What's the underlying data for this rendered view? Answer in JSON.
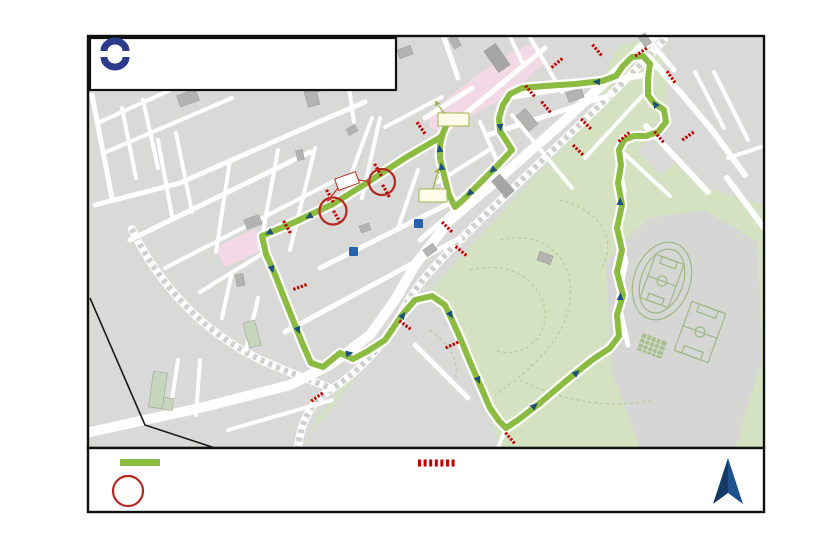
{
  "page": {
    "side_label": "page 2/3"
  },
  "title_box": {
    "line1": "Flèche du Sud 2023",
    "line2": "Prologue mercredi, le 17 mai 2023",
    "logo_text": "esch"
  },
  "legend": {
    "route_label": "Parcours du Prologue de la Flèche du Sud",
    "closure_line1": "Fermeture du parcours et des rues adjacentes",
    "closure_line2": "de 15.00 heures jusqu'à 20.00 heures",
    "ppo_title": "PPO",
    "ppo_desc": "Point de passage obligatoire"
  },
  "markers": {
    "depart": "Départ",
    "arrivee": "Arrivée",
    "ppo": "PPO",
    "north_label": "N",
    "museum_icon": "M"
  },
  "colors": {
    "route_green": "#8cbb41",
    "closure_red": "#c00000",
    "ppo_red": "#b5291f",
    "arrow_navy": "#1d4f7c",
    "park_green": "#d5e2c2",
    "pink_zone": "#f3d9e6",
    "map_gray": "#d9d9d7",
    "logo_blue": "#2c3a8c"
  },
  "map": {
    "street_labels": [
      {
        "t": "STALINGRAD",
        "x": 99,
        "y": 140,
        "r": 80
      },
      {
        "t": "HUGO",
        "x": 122,
        "y": 96,
        "r": -25
      },
      {
        "t": "EDISON",
        "x": 138,
        "y": 124,
        "r": -22
      },
      {
        "t": "CHAMPS",
        "x": 163,
        "y": 178,
        "r": 78
      },
      {
        "t": "ARGENTINE",
        "x": 179,
        "y": 160,
        "r": 78
      },
      {
        "t": "CANAL",
        "x": 150,
        "y": 187,
        "r": -18
      },
      {
        "t": "CANAL",
        "x": 288,
        "y": 140,
        "r": 78
      },
      {
        "t": "RP DAICH",
        "x": 123,
        "y": 213,
        "r": -15
      },
      {
        "t": "SPOO",
        "x": 190,
        "y": 225,
        "r": -15
      },
      {
        "t": "BRILL",
        "x": 224,
        "y": 208,
        "r": 78
      },
      {
        "t": "DICKS",
        "x": 272,
        "y": 192,
        "r": 78
      },
      {
        "t": "DICKS",
        "x": 318,
        "y": 238,
        "r": 78
      },
      {
        "t": "PASTEUR",
        "x": 252,
        "y": 221,
        "r": -25
      },
      {
        "t": "PASTEUR",
        "x": 196,
        "y": 252,
        "r": -15
      },
      {
        "t": "RESISTANCE",
        "x": 238,
        "y": 246,
        "r": -18
      },
      {
        "t": "PRINCE HENRI",
        "x": 153,
        "y": 258,
        "r": 65
      },
      {
        "t": "PRINCE HENRI",
        "x": 243,
        "y": 357,
        "r": 28
      },
      {
        "t": "Prince Henri",
        "x": 140,
        "y": 342,
        "r": 0
      },
      {
        "t": "CLAUDE",
        "x": 228,
        "y": 296,
        "r": 80
      },
      {
        "t": "MANDELA",
        "x": 291,
        "y": 328,
        "r": 75
      },
      {
        "t": "SEPTEMBRE",
        "x": 302,
        "y": 180,
        "r": 78
      },
      {
        "t": "MOULIN",
        "x": 346,
        "y": 158,
        "r": -30
      },
      {
        "t": "EAU",
        "x": 411,
        "y": 108,
        "r": -28
      },
      {
        "t": "LIBERATION",
        "x": 371,
        "y": 146,
        "r": 78
      },
      {
        "t": "LIBERATION",
        "x": 417,
        "y": 237,
        "r": -15
      },
      {
        "t": "BOLTGEN",
        "x": 444,
        "y": 104,
        "r": -22
      },
      {
        "t": "ALZETTE",
        "x": 346,
        "y": 201,
        "r": -24,
        "c": "#ffffff"
      },
      {
        "t": "ALZETTE",
        "x": 470,
        "y": 126,
        "r": -38
      },
      {
        "t": "GARE",
        "x": 433,
        "y": 150,
        "r": 82,
        "c": "#ffffff"
      },
      {
        "t": "REITZ",
        "x": 461,
        "y": 163,
        "r": -15
      },
      {
        "t": "JARDINS",
        "x": 489,
        "y": 143,
        "r": 58
      },
      {
        "t": "BOLIVAR",
        "x": 408,
        "y": 190,
        "r": 72
      },
      {
        "t": "NOTHOMB",
        "x": 438,
        "y": 211,
        "r": 55
      },
      {
        "t": "KENNEDY",
        "x": 484,
        "y": 187,
        "r": 48
      },
      {
        "t": "KENNEDY",
        "x": 404,
        "y": 299,
        "r": -42
      },
      {
        "t": "ANTOINE KRIER",
        "x": 540,
        "y": 147,
        "r": 52
      },
      {
        "t": "ST ANTOINE",
        "x": 556,
        "y": 112,
        "r": -14
      },
      {
        "t": "BUSHHOLTZ",
        "x": 543,
        "y": 62,
        "r": 52
      },
      {
        "t": "GRAND RUE",
        "x": 448,
        "y": 46,
        "r": 62
      },
      {
        "t": "HOTEL DE VILLE",
        "x": 497,
        "y": 63,
        "r": 55,
        "s": 4
      },
      {
        "t": "QUARTIER",
        "x": 590,
        "y": 82,
        "r": -20
      },
      {
        "t": "SCHNEIDER",
        "x": 611,
        "y": 121,
        "r": -44
      },
      {
        "t": "STADE",
        "x": 637,
        "y": 94,
        "r": 60
      },
      {
        "t": "STADE",
        "x": 632,
        "y": 152,
        "r": 85
      },
      {
        "t": "STADE",
        "x": 554,
        "y": 389,
        "r": -40
      },
      {
        "t": "BASTIAN",
        "x": 643,
        "y": 163,
        "r": 50
      },
      {
        "t": "ESCHEN",
        "x": 676,
        "y": 146,
        "r": 60
      },
      {
        "t": "NEIDUERF",
        "x": 681,
        "y": 91,
        "r": 42
      },
      {
        "t": "ST NICOLAS",
        "x": 707,
        "y": 97,
        "r": 65
      },
      {
        "t": "ALBERT GOEDERT",
        "x": 729,
        "y": 110,
        "r": 62
      },
      {
        "t": "KAYL",
        "x": 746,
        "y": 148,
        "r": -8
      },
      {
        "t": "SCHIFFLANGE",
        "x": 650,
        "y": 52,
        "r": 55
      },
      {
        "t": "REMPART",
        "x": 352,
        "y": 96,
        "r": 85
      },
      {
        "t": "BARBE",
        "x": 198,
        "y": 100,
        "r": 85
      },
      {
        "t": "AUDUN",
        "x": 242,
        "y": 412,
        "r": -10
      },
      {
        "t": "AUDUN",
        "x": 297,
        "y": 394,
        "r": -32
      },
      {
        "t": "FRONTIERE",
        "x": 256,
        "y": 420,
        "r": -8
      },
      {
        "t": "TERRES ROUGES",
        "x": 201,
        "y": 380,
        "r": 80
      },
      {
        "t": "ACACIAS",
        "x": 180,
        "y": 390,
        "r": 80
      },
      {
        "t": "ANDRE KOCH",
        "x": 441,
        "y": 368,
        "r": -52
      },
      {
        "t": "DIESWEE",
        "x": 397,
        "y": 313,
        "r": -42
      },
      {
        "t": "DIESWEE",
        "x": 465,
        "y": 341,
        "r": 72
      },
      {
        "t": "BERNARD",
        "x": 333,
        "y": 256,
        "r": -20
      },
      {
        "t": "BRASSEUR",
        "x": 366,
        "y": 262,
        "r": 70
      },
      {
        "t": "INDUSTRIE",
        "x": 287,
        "y": 258,
        "r": -22
      }
    ]
  }
}
